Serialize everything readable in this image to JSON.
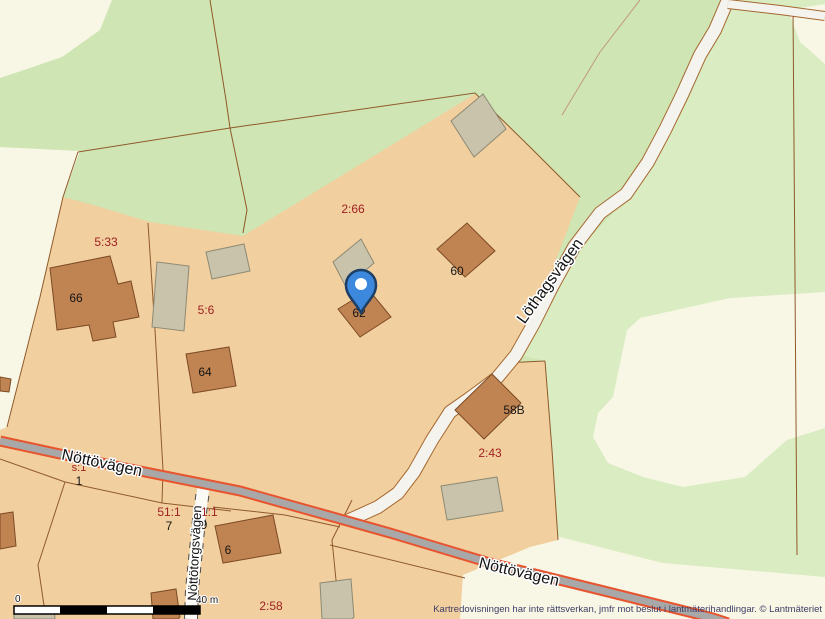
{
  "map_type": "cadastral-map",
  "colors": {
    "forest_green": "#cfe5b3",
    "forest_green_light": "#d9ecc2",
    "clearing_cream": "#f8f6e4",
    "parcel_tan": "#f2cf9f",
    "building_brown": "#c08352",
    "building_gray": "#c9c3ab",
    "boundary_brown": "#8f5a2b",
    "road_major_fill": "#a8a8a8",
    "road_major_edge": "#e8542e",
    "road_minor_fill": "#f4f3ed",
    "road_minor_edge": "#a5672f",
    "parcel_label_red": "#9e2121",
    "label_black": "#141414",
    "attribution_blue": "#3d3d66",
    "marker_blue": "#3c88dd",
    "marker_outline": "#1d3f66"
  },
  "parcel_labels": {
    "p2_66": "2:66",
    "p5_33": "5:33",
    "p5_6": "5:6",
    "p2_43": "2:43",
    "p2_58": "2:58",
    "ps_1": "s:1",
    "p51_1_a": "51:1",
    "p51_1_b": "51:1"
  },
  "address_labels": {
    "n66": "66",
    "n64": "64",
    "n62": "62",
    "n60": "60",
    "n58b": "58B",
    "n6": "6",
    "n1": "1",
    "n7": "7",
    "n9": "9"
  },
  "road_labels": {
    "nottovagen_west": "Nöttövägen",
    "nottovagen_east": "Nöttövägen",
    "lothagsvagen": "Löthagsvägen",
    "nottotorgsvagen": "Nöttötorgsvägen"
  },
  "scale_bar": {
    "start": "0",
    "end": "40 m"
  },
  "attribution": "Kartredovisningen har inte rättsverkan, jmfr mot beslut i lantmäterihandlingar. © Lantmäteriet",
  "marker": {
    "name": "location-pin"
  }
}
